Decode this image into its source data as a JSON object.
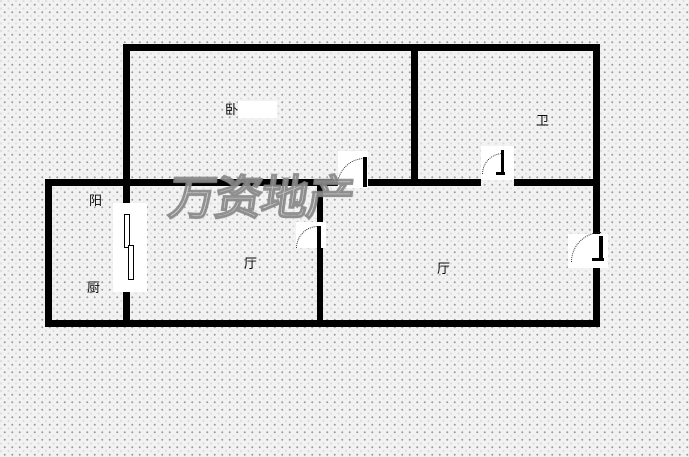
{
  "watermark": {
    "text": "万资地产",
    "color": "#b7b7b7"
  },
  "rooms": {
    "bedroom": {
      "label": "卧"
    },
    "bathroom": {
      "label": "卫"
    },
    "balcony": {
      "label": "阳"
    },
    "kitchen": {
      "label": "厨"
    },
    "hall": {
      "label": "厅"
    },
    "living": {
      "label": "厅"
    }
  },
  "doors": {
    "bedroom_door": {
      "type": "swing"
    },
    "bathroom_door": {
      "type": "swing"
    },
    "hall_door": {
      "type": "swing"
    },
    "entry_door": {
      "type": "swing"
    },
    "kitchen_slider": {
      "type": "sliding"
    }
  },
  "colors": {
    "wall": "#000000",
    "background": "#f2f2f2",
    "grid_dot": "#9c9c9c"
  }
}
